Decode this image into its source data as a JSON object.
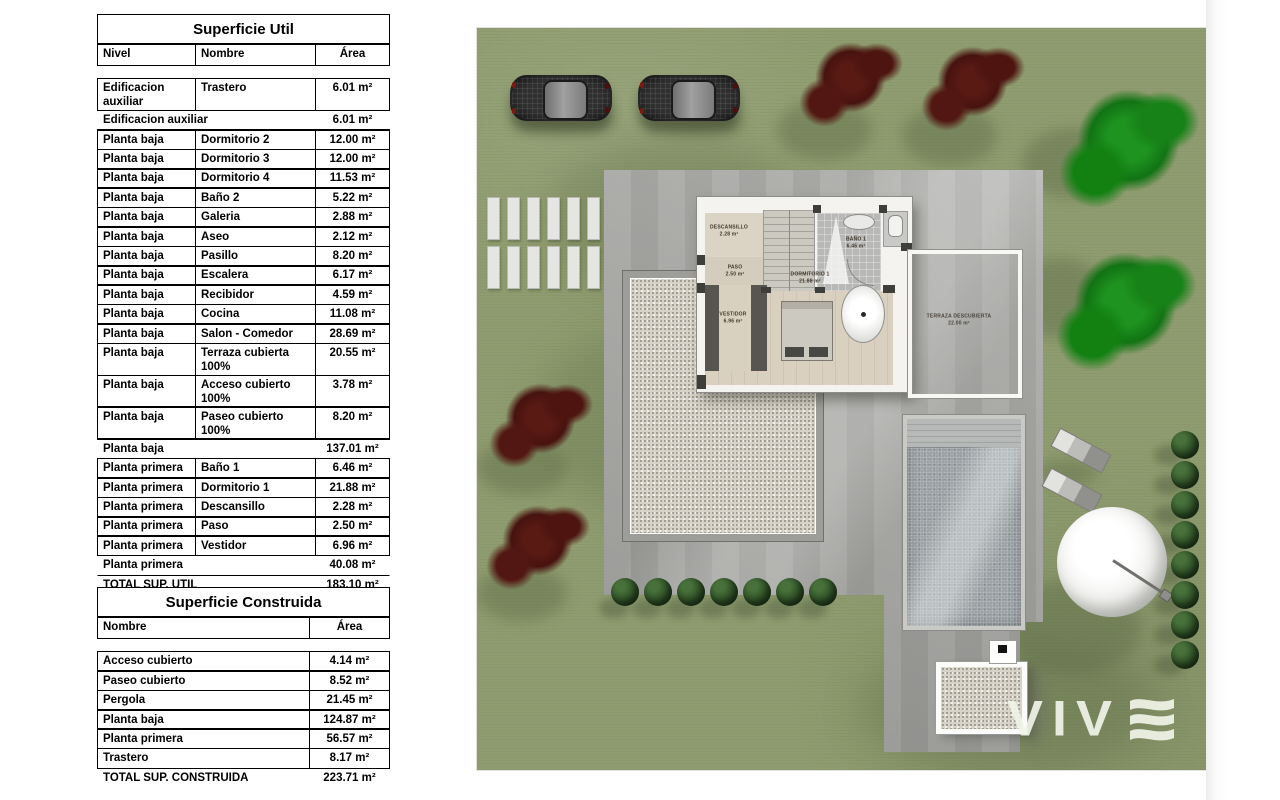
{
  "tables": {
    "util": {
      "title": "Superficie Util",
      "columns": [
        "Nivel",
        "Nombre",
        "Área"
      ],
      "rows": [
        {
          "kind": "data",
          "c": [
            "Edificacion auxiliar",
            "Trastero"
          ],
          "area": "6.01 m²"
        },
        {
          "kind": "subtotal",
          "c": [
            "Edificacion auxiliar"
          ],
          "area": "6.01 m²"
        },
        {
          "kind": "data",
          "c": [
            "Planta baja",
            "Dormitorio 2"
          ],
          "area": "12.00 m²"
        },
        {
          "kind": "data",
          "c": [
            "Planta baja",
            "Dormitorio 3"
          ],
          "area": "12.00 m²"
        },
        {
          "kind": "data",
          "c": [
            "Planta baja",
            "Dormitorio 4"
          ],
          "area": "11.53 m²"
        },
        {
          "kind": "data",
          "c": [
            "Planta baja",
            "Baño 2"
          ],
          "area": "5.22 m²"
        },
        {
          "kind": "data",
          "c": [
            "Planta baja",
            "Galeria"
          ],
          "area": "2.88 m²"
        },
        {
          "kind": "data",
          "c": [
            "Planta baja",
            "Aseo"
          ],
          "area": "2.12 m²"
        },
        {
          "kind": "data",
          "c": [
            "Planta baja",
            "Pasillo"
          ],
          "area": "8.20 m²"
        },
        {
          "kind": "data",
          "c": [
            "Planta baja",
            "Escalera"
          ],
          "area": "6.17 m²"
        },
        {
          "kind": "data",
          "c": [
            "Planta baja",
            "Recibidor"
          ],
          "area": "4.59 m²"
        },
        {
          "kind": "data",
          "c": [
            "Planta baja",
            "Cocina"
          ],
          "area": "11.08 m²"
        },
        {
          "kind": "data",
          "c": [
            "Planta baja",
            "Salon - Comedor"
          ],
          "area": "28.69 m²"
        },
        {
          "kind": "data",
          "c": [
            "Planta baja",
            "Terraza cubierta 100%"
          ],
          "area": "20.55 m²"
        },
        {
          "kind": "data",
          "c": [
            "Planta baja",
            "Acceso cubierto 100%"
          ],
          "area": "3.78 m²"
        },
        {
          "kind": "data",
          "c": [
            "Planta baja",
            "Paseo cubierto 100%"
          ],
          "area": "8.20 m²"
        },
        {
          "kind": "subtotal",
          "c": [
            "Planta baja"
          ],
          "area": "137.01 m²"
        },
        {
          "kind": "data",
          "c": [
            "Planta primera",
            "Baño 1"
          ],
          "area": "6.46 m²"
        },
        {
          "kind": "data",
          "c": [
            "Planta primera",
            "Dormitorio 1"
          ],
          "area": "21.88 m²"
        },
        {
          "kind": "data",
          "c": [
            "Planta primera",
            "Descansillo"
          ],
          "area": "2.28 m²"
        },
        {
          "kind": "data",
          "c": [
            "Planta primera",
            "Paso"
          ],
          "area": "2.50 m²"
        },
        {
          "kind": "data",
          "c": [
            "Planta primera",
            "Vestidor"
          ],
          "area": "6.96 m²"
        },
        {
          "kind": "subtotal",
          "c": [
            "Planta primera"
          ],
          "area": "40.08 m²"
        },
        {
          "kind": "total",
          "c": [
            "TOTAL SUP. UTIL"
          ],
          "area": "183.10 m²"
        }
      ]
    },
    "construida": {
      "title": "Superficie Construida",
      "columns": [
        "Nombre",
        "Área"
      ],
      "rows": [
        {
          "kind": "data",
          "c": [
            "Acceso cubierto"
          ],
          "area": "4.14 m²"
        },
        {
          "kind": "data",
          "c": [
            "Paseo cubierto"
          ],
          "area": "8.52 m²"
        },
        {
          "kind": "data",
          "c": [
            "Pergola"
          ],
          "area": "21.45 m²"
        },
        {
          "kind": "data",
          "c": [
            "Planta baja"
          ],
          "area": "124.87 m²"
        },
        {
          "kind": "data",
          "c": [
            "Planta primera"
          ],
          "area": "56.57 m²"
        },
        {
          "kind": "data",
          "c": [
            "Trastero"
          ],
          "area": "8.17 m²"
        },
        {
          "kind": "total",
          "c": [
            "TOTAL SUP. CONSTRUIDA"
          ],
          "area": "223.71 m²"
        }
      ]
    }
  },
  "plan": {
    "rooms": [
      {
        "name": "DESCANSILLO",
        "area": "2.28 m²"
      },
      {
        "name": "PASO",
        "area": "2.50 m²"
      },
      {
        "name": "BAÑO 1",
        "area": "6.46 m²"
      },
      {
        "name": "DORMITORIO 1",
        "area": "21.88 m²"
      },
      {
        "name": "VESTIDOR",
        "area": "6.96 m²"
      },
      {
        "name": "TERRAZA DESCUBIERTA",
        "area": "22.00 m²"
      }
    ],
    "watermark": {
      "brand": "VIVE",
      "text": "VIV"
    },
    "stepping_stones": {
      "rows": 2,
      "cols": 6
    },
    "bushes_bottom": {
      "count": 7
    },
    "bushes_right": {
      "count": 8
    },
    "cars": {
      "count": 2
    },
    "trees": {
      "red": 4,
      "green": 2
    }
  },
  "colors": {
    "grass": "#8e9b6e",
    "patio": "#a3a3a0",
    "gravel": "#d7d3c8",
    "pool": "#9ba1a4",
    "tree_red": "#4d130e",
    "tree_green": "#1d9220",
    "bush": "#2c4b24",
    "watermark": "#eef3e8"
  }
}
